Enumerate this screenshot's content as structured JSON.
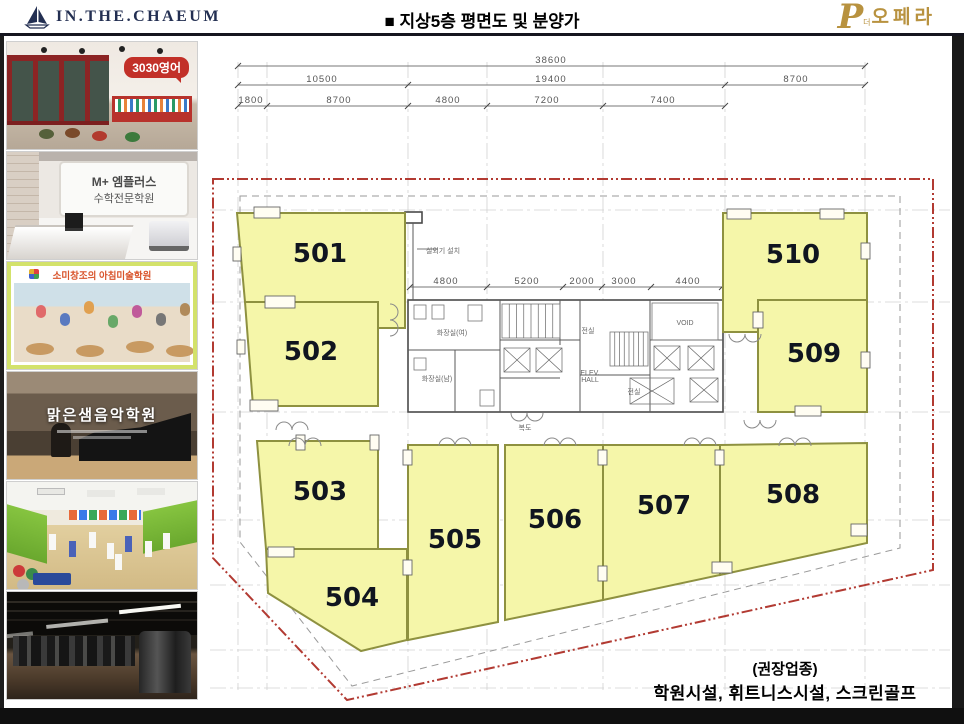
{
  "header": {
    "brand": "IN.THE.CHAEUM",
    "title": "■ 지상5층 평면도 및 분양가",
    "logo_p": "P",
    "logo_small": "더",
    "logo_text": "오페라"
  },
  "photos": {
    "english_sign": "3030영어",
    "math_sign_line1": "M+ 엠플러스",
    "math_sign_line2": "수학전문학원",
    "art_sign": "소미창조의 아침미술학원",
    "music_sign": "맑은샘음악학원"
  },
  "note": {
    "line1": "(권장업종)",
    "line2": "학원시설, 휘트니스시설, 스크린골프"
  },
  "plan": {
    "units": [
      {
        "id": "501",
        "points": "237,213 405,213 405,328 378,328 378,302 245,302",
        "lx": 320,
        "ly": 262
      },
      {
        "id": "502",
        "points": "245,302 378,302 378,406 253,406",
        "lx": 311,
        "ly": 360
      },
      {
        "id": "503",
        "points": "257,441 378,441 378,549 266,549",
        "lx": 320,
        "ly": 500
      },
      {
        "id": "504",
        "points": "266,549 407,549 407,640 361,651 268,593",
        "lx": 352,
        "ly": 606
      },
      {
        "id": "505",
        "points": "408,445 498,445 498,622 408,640",
        "lx": 455,
        "ly": 548
      },
      {
        "id": "506",
        "points": "505,445 603,445 603,600 505,620",
        "lx": 555,
        "ly": 528
      },
      {
        "id": "507",
        "points": "603,445 720,445 720,575 603,600",
        "lx": 664,
        "ly": 514
      },
      {
        "id": "508",
        "points": "720,445 867,443 867,543 720,575",
        "lx": 793,
        "ly": 503
      },
      {
        "id": "509",
        "points": "758,300 867,300 867,412 758,412",
        "lx": 814,
        "ly": 362
      },
      {
        "id": "510",
        "points": "723,213 867,213 867,300 758,300 758,332 723,332",
        "lx": 793,
        "ly": 263
      }
    ],
    "dim_rows": [
      {
        "y": 66,
        "x1": 238,
        "x2": 865,
        "ticks": [
          238,
          865
        ],
        "labels": [
          {
            "t": "38600",
            "x": 551
          }
        ]
      },
      {
        "y": 85,
        "x1": 238,
        "x2": 865,
        "ticks": [
          238,
          408,
          725,
          865
        ],
        "labels": [
          {
            "t": "10500",
            "x": 322
          },
          {
            "t": "19400",
            "x": 551
          },
          {
            "t": "8700",
            "x": 796
          }
        ]
      },
      {
        "y": 106,
        "x1": 238,
        "x2": 725,
        "ticks": [
          238,
          267,
          408,
          487,
          603,
          725
        ],
        "labels": [
          {
            "t": "1800",
            "x": 251
          },
          {
            "t": "8700",
            "x": 339
          },
          {
            "t": "4800",
            "x": 448
          },
          {
            "t": "7200",
            "x": 547
          },
          {
            "t": "7400",
            "x": 663
          }
        ]
      },
      {
        "y": 287,
        "x1": 410,
        "x2": 722,
        "ticks": [
          410,
          487,
          563,
          602,
          651,
          722
        ],
        "labels": [
          {
            "t": "4800",
            "x": 446
          },
          {
            "t": "5200",
            "x": 527
          },
          {
            "t": "2000",
            "x": 582
          },
          {
            "t": "3000",
            "x": 624
          },
          {
            "t": "4400",
            "x": 688
          }
        ]
      }
    ],
    "grid_v": [
      238,
      267,
      408,
      487,
      603,
      725,
      865
    ],
    "grid_h": [
      210,
      302,
      412,
      520,
      585,
      650,
      688
    ],
    "red_boundary": "M213,179 H933 V570 L347,700 L213,558 Z",
    "grey_offset": "M240,196 H900 V548 L352,686 L240,542 Z",
    "core": {
      "outer": [
        408,
        300,
        315,
        112
      ],
      "vlines": [
        [
          500,
          300,
          500,
          412
        ],
        [
          560,
          300,
          560,
          345
        ],
        [
          580,
          300,
          580,
          412
        ],
        [
          650,
          300,
          650,
          412
        ],
        [
          455,
          350,
          455,
          412
        ]
      ],
      "hlines": [
        [
          408,
          350,
          500,
          350
        ],
        [
          500,
          340,
          580,
          340
        ],
        [
          580,
          375,
          650,
          375
        ],
        [
          650,
          340,
          723,
          340
        ],
        [
          500,
          378,
          560,
          378
        ]
      ],
      "stairs": [
        [
          502,
          304,
          58,
          34
        ],
        [
          610,
          332,
          38,
          34
        ]
      ],
      "xboxes": [
        [
          504,
          348,
          26,
          24
        ],
        [
          536,
          348,
          26,
          24
        ],
        [
          654,
          346,
          26,
          24
        ],
        [
          688,
          346,
          26,
          24
        ],
        [
          630,
          378,
          44,
          26
        ],
        [
          690,
          378,
          28,
          24
        ]
      ],
      "void_rect": [
        652,
        303,
        66,
        37
      ],
      "fixtures": [
        [
          414,
          305,
          12,
          14
        ],
        [
          432,
          305,
          12,
          14
        ],
        [
          468,
          305,
          14,
          16
        ],
        [
          414,
          358,
          12,
          12
        ],
        [
          480,
          390,
          14,
          16
        ]
      ],
      "stub": [
        405,
        212,
        17,
        11
      ],
      "stub_line": [
        413,
        223,
        413,
        300
      ]
    },
    "openings": [
      [
        254,
        207,
        26,
        11
      ],
      [
        265,
        296,
        30,
        12
      ],
      [
        250,
        400,
        28,
        11
      ],
      [
        268,
        547,
        26,
        10
      ],
      [
        403,
        450,
        9,
        15
      ],
      [
        403,
        560,
        9,
        15
      ],
      [
        598,
        450,
        9,
        15
      ],
      [
        598,
        566,
        9,
        15
      ],
      [
        715,
        450,
        9,
        15
      ],
      [
        712,
        562,
        20,
        11
      ],
      [
        851,
        524,
        16,
        12
      ],
      [
        727,
        209,
        24,
        10
      ],
      [
        820,
        209,
        24,
        10
      ],
      [
        795,
        406,
        26,
        10
      ],
      [
        753,
        312,
        10,
        16
      ],
      [
        861,
        243,
        9,
        16
      ],
      [
        861,
        352,
        9,
        16
      ],
      [
        233,
        247,
        8,
        14
      ],
      [
        237,
        340,
        8,
        14
      ],
      [
        296,
        435,
        9,
        15
      ],
      [
        370,
        435,
        9,
        15
      ]
    ],
    "doors": [
      {
        "x": 305,
        "y": 446,
        "d": "up"
      },
      {
        "x": 455,
        "y": 446,
        "d": "up"
      },
      {
        "x": 560,
        "y": 446,
        "d": "up"
      },
      {
        "x": 700,
        "y": 446,
        "d": "up"
      },
      {
        "x": 795,
        "y": 446,
        "d": "up"
      },
      {
        "x": 292,
        "y": 430,
        "d": "up"
      },
      {
        "x": 527,
        "y": 413,
        "d": "down"
      },
      {
        "x": 390,
        "y": 320,
        "d": "right"
      },
      {
        "x": 745,
        "y": 334,
        "d": "down"
      },
      {
        "x": 760,
        "y": 420,
        "d": "down"
      }
    ],
    "texts": [
      {
        "t": "실외기 설치",
        "x": 443,
        "y": 253,
        "a": "start",
        "s": 8
      },
      {
        "t": "화장실(여)",
        "x": 452,
        "y": 335,
        "s": 7
      },
      {
        "t": "화장실(남)",
        "x": 437,
        "y": 381,
        "s": 7
      },
      {
        "t": "전실",
        "x": 588,
        "y": 333,
        "s": 7
      },
      {
        "t": "전실",
        "x": 634,
        "y": 394,
        "s": 7
      },
      {
        "t": "VOID",
        "x": 685,
        "y": 325,
        "s": 6
      },
      {
        "t": "ELEV.",
        "x": 590,
        "y": 375,
        "s": 5.5
      },
      {
        "t": "HALL",
        "x": 590,
        "y": 382,
        "s": 5.5
      },
      {
        "t": "복도",
        "x": 525,
        "y": 430,
        "s": 8
      }
    ],
    "leader": [
      417,
      249,
      438,
      249
    ]
  }
}
